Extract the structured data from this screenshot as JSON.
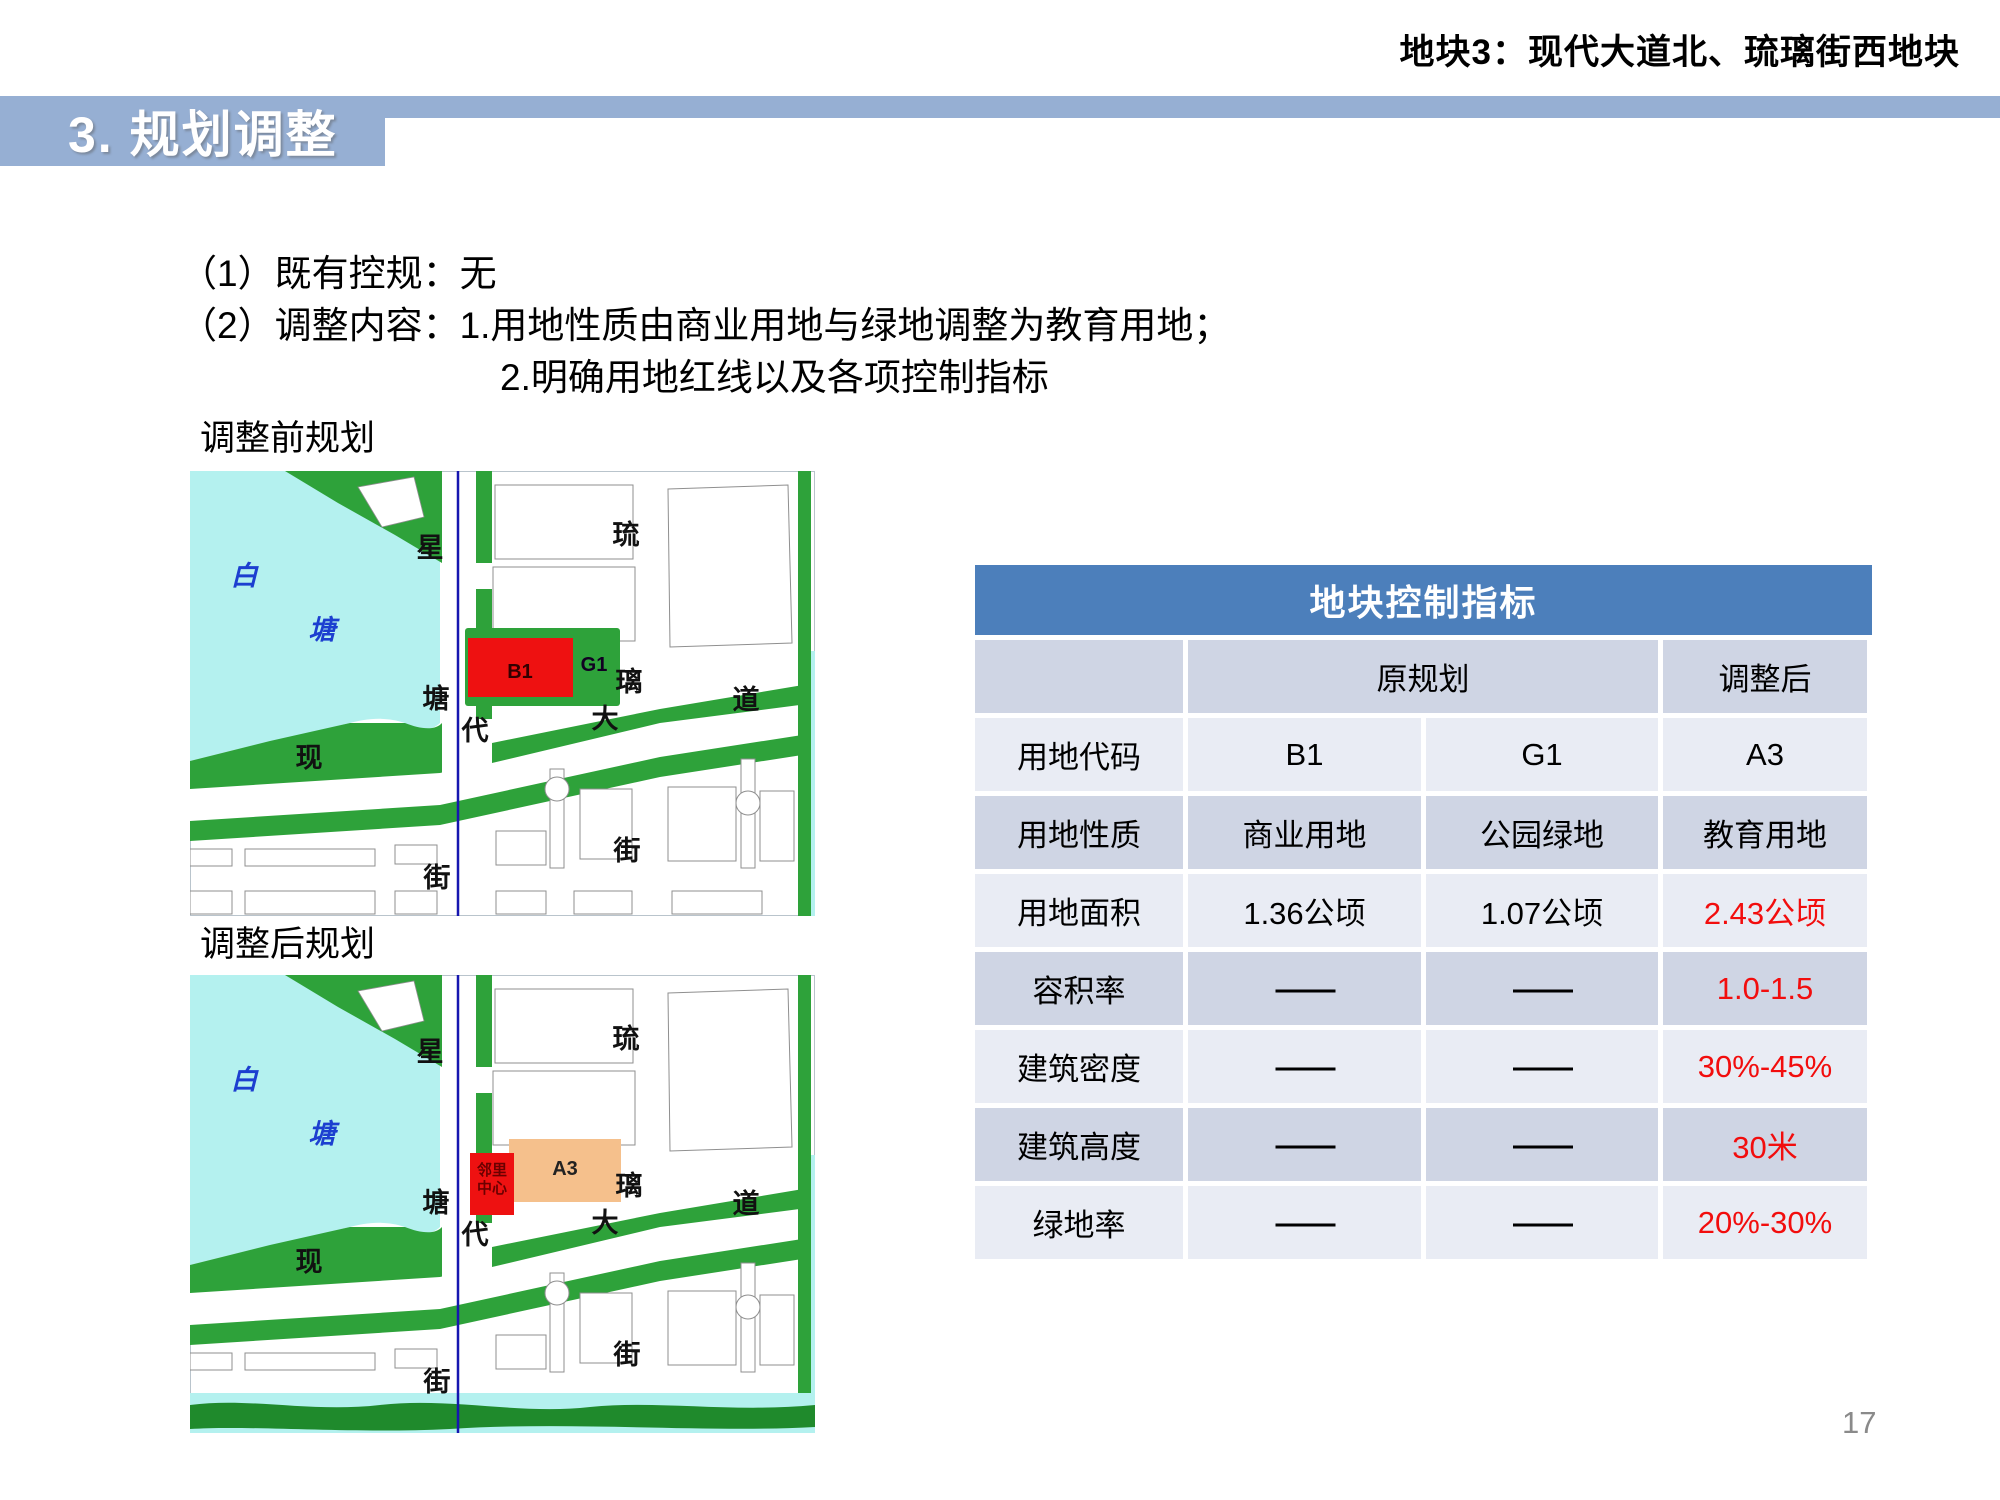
{
  "page_header": "地块3：现代大道北、琉璃街西地块",
  "section_title": "3. 规划调整",
  "body": {
    "line1": "（1）既有控规：无",
    "line2": "（2）调整内容：1.用地性质由商业用地与绿地调整为教育用地；",
    "line3": "2.明确用地红线以及各项控制指标"
  },
  "maps": {
    "before_label": "调整前规划",
    "after_label": "调整后规划",
    "water_label": [
      "白",
      "塘"
    ],
    "streets": {
      "xingtang_street": [
        "星",
        "塘",
        "街"
      ],
      "liuli_street": [
        "琉",
        "璃",
        "街"
      ],
      "xiandai_avenue": [
        "现",
        "代",
        "大",
        "道"
      ]
    },
    "parcels_before": {
      "b1_label": "B1",
      "g1_label": "G1"
    },
    "parcels_after": {
      "center_line1": "邻里",
      "center_line2": "中心",
      "a3_label": "A3"
    },
    "colors": {
      "water": "#b4f1ef",
      "green": "#2ea23a",
      "dark_green": "#1f8a2c",
      "red_parcel": "#ee1111",
      "orange_parcel": "#f5c08c",
      "river": "#1616b0",
      "block_outline": "#8f8f8f",
      "water_text": "#1c3fd0"
    }
  },
  "table": {
    "title": "地块控制指标",
    "col_headers": {
      "original": "原规划",
      "adjusted": "调整后"
    },
    "rows": [
      {
        "label": "用地代码",
        "orig1": "B1",
        "orig2": "G1",
        "adjusted": "A3",
        "adjusted_red": false,
        "dash": false
      },
      {
        "label": "用地性质",
        "orig1": "商业用地",
        "orig2": "公园绿地",
        "adjusted": "教育用地",
        "adjusted_red": false,
        "dash": false
      },
      {
        "label": "用地面积",
        "orig1": "1.36公顷",
        "orig2": "1.07公顷",
        "adjusted": "2.43公顷",
        "adjusted_red": true,
        "dash": false
      },
      {
        "label": "容积率",
        "orig1": "——",
        "orig2": "——",
        "adjusted": "1.0-1.5",
        "adjusted_red": true,
        "dash": true
      },
      {
        "label": "建筑密度",
        "orig1": "——",
        "orig2": "——",
        "adjusted": "30%-45%",
        "adjusted_red": true,
        "dash": true
      },
      {
        "label": "建筑高度",
        "orig1": "——",
        "orig2": "——",
        "adjusted": "30米",
        "adjusted_red": true,
        "dash": true
      },
      {
        "label": "绿地率",
        "orig1": "——",
        "orig2": "——",
        "adjusted": "20%-30%",
        "adjusted_red": true,
        "dash": true
      }
    ]
  },
  "page_number": "17",
  "colors": {
    "band_blue": "#96afd3",
    "table_header_blue": "#4c7fbb",
    "row_dark": "#cfd5e4",
    "row_light": "#e9ecf4",
    "highlight_red": "#f20d0d"
  }
}
